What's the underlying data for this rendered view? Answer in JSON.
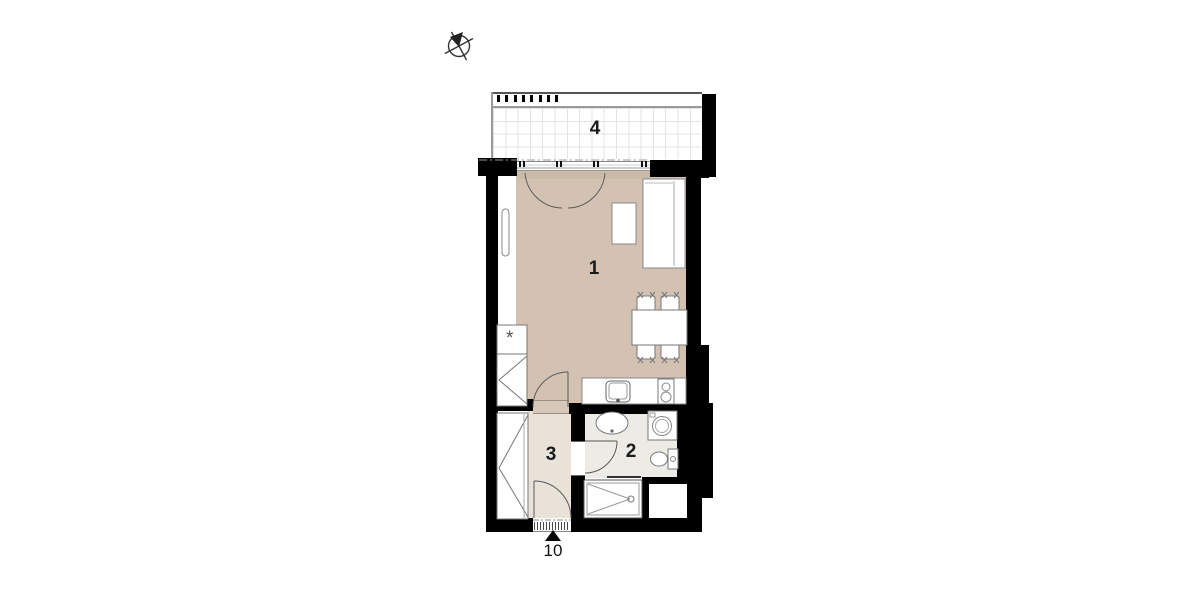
{
  "plan": {
    "room_labels": [
      {
        "room": "living-room",
        "text": "1"
      },
      {
        "room": "bathroom",
        "text": "2"
      },
      {
        "room": "hall",
        "text": "3"
      },
      {
        "room": "balcony",
        "text": "4"
      }
    ],
    "unit_label": "10",
    "fridge_symbol": "*"
  },
  "icons": [
    "compass-icon",
    "entrance-arrow-icon"
  ],
  "colors": {
    "wall": "#000000",
    "living_room_floor": "#d3c1b2",
    "bathroom_floor": "#ecebe6",
    "hall_floor": "#e8e2d9",
    "door_threshold": "#d5c8b9",
    "window_sill": "#cabba8",
    "furniture_outline": "#777777",
    "tile_grid": "#e3e3e3"
  }
}
